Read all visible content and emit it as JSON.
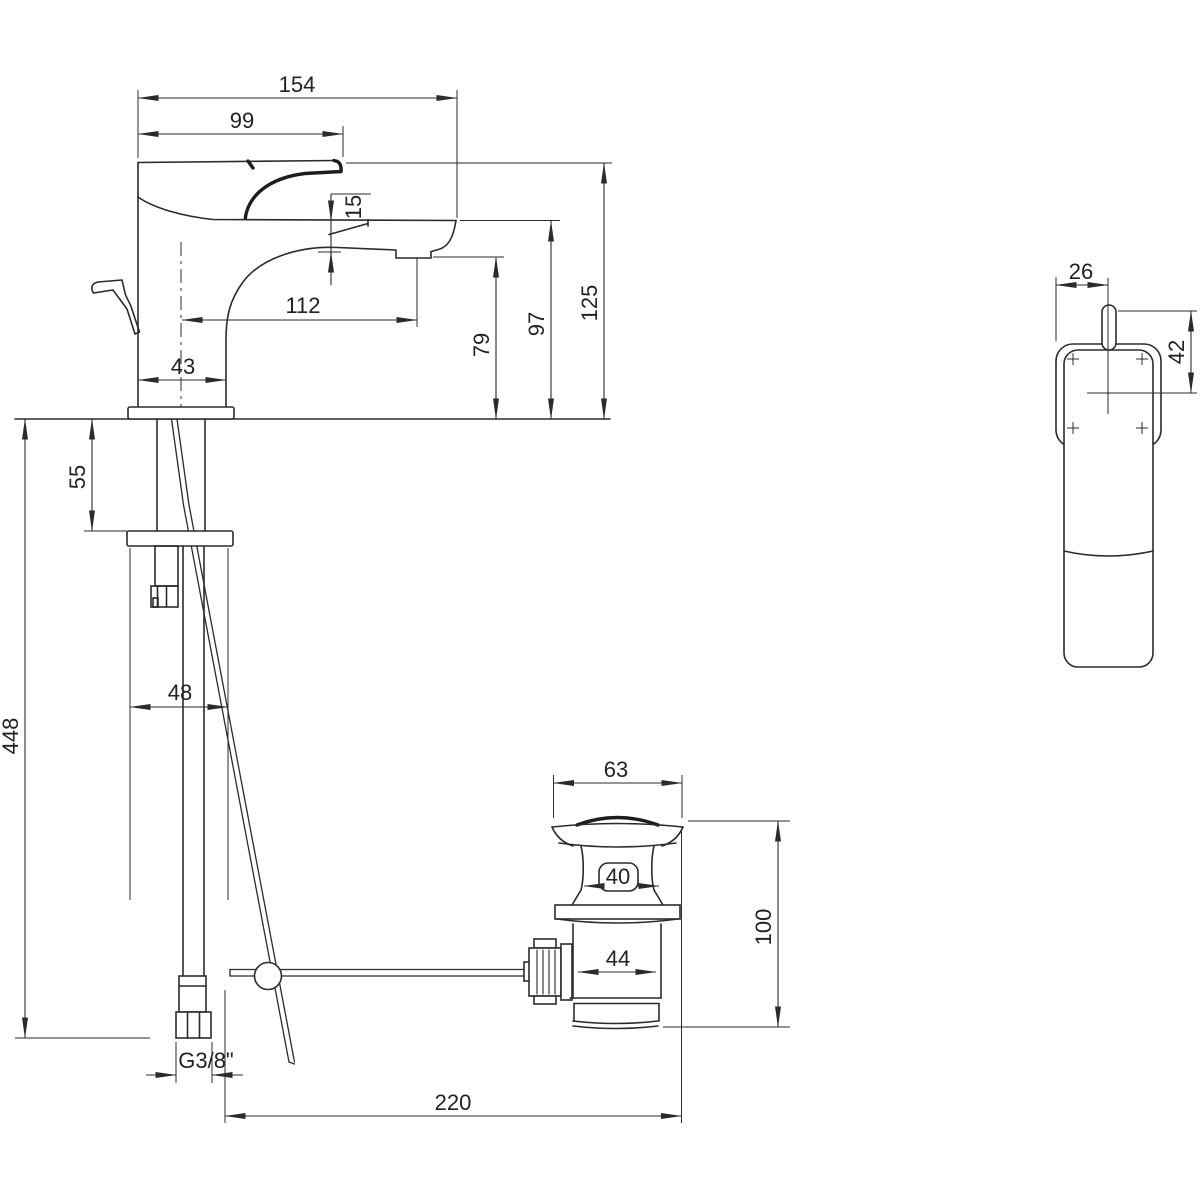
{
  "colors": {
    "line": "#2b2b2b"
  },
  "side_view": {
    "overall_projection": "154",
    "handle_projection": "99",
    "spout_lip_drop": "15",
    "spout_reach": "112",
    "body_depth": "43",
    "overall_height": "125",
    "spout_top_height": "97",
    "aerator_height": "79"
  },
  "installation": {
    "shank_clearance": "55",
    "hose_length": "448",
    "bracket_width": "48",
    "hose_thread": "G3/8\""
  },
  "waste": {
    "flange_diameter": "63",
    "plug_diameter": "40",
    "height": "100",
    "body_diameter": "44",
    "rod_reach": "220"
  },
  "top_view": {
    "centre_offset": "26",
    "handle_offset": "42"
  }
}
